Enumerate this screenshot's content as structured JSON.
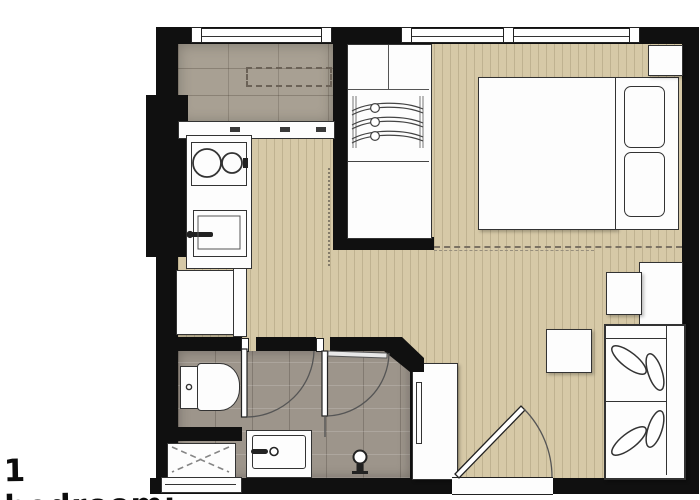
{
  "caption": {
    "label": "1 bedroom:"
  },
  "plan": {
    "type": "floor-plan",
    "unit": "1 bedroom apartment",
    "rooms": [
      "kitchen",
      "bathroom",
      "bedroom",
      "living-area",
      "entry"
    ],
    "fixtures": [
      "window",
      "wardrobe-with-hangers",
      "double-bed",
      "pillows",
      "nightstand",
      "two-burner-hob",
      "kitchen-sink",
      "refrigerator",
      "kitchen-counter",
      "overhead-cabinet-dashed",
      "toilet",
      "shower-tray",
      "wash-basin-vanity",
      "bathroom-door",
      "entrance-door",
      "tall-cabinet",
      "coffee-table",
      "corner-side-tables",
      "sofa-with-leaf-cushions",
      "sliding-track-dashed"
    ],
    "colors": {
      "wall": "#101010",
      "wood_floor": "#d6c9a7",
      "kitchen_tile": "#a8a093",
      "bath_tile": "#9d958b",
      "furniture_fill": "#fdfdfd",
      "outline": "#333333",
      "background": "#ffffff"
    }
  }
}
